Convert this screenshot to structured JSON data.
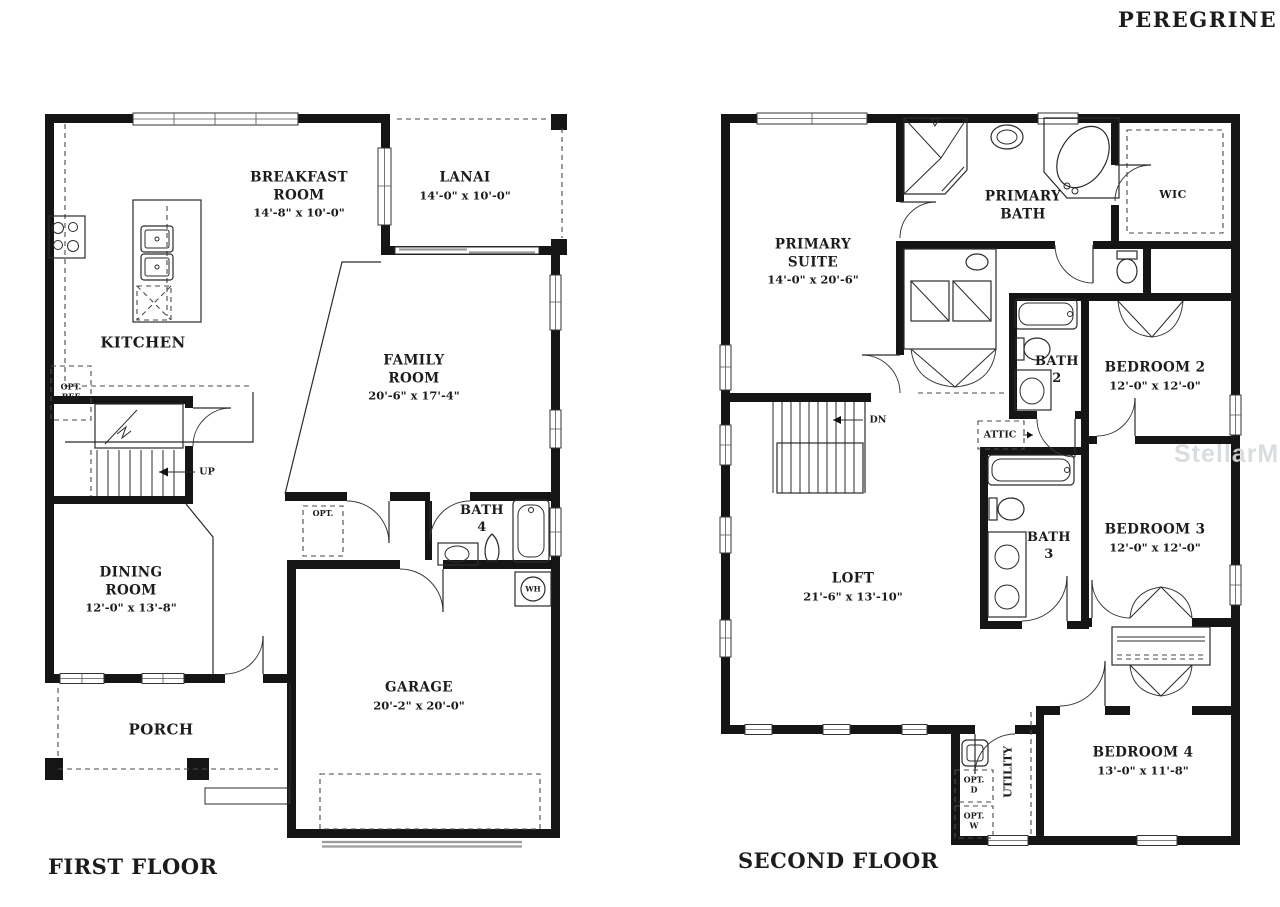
{
  "plan_title": "PEREGRINE",
  "watermark": "StellarMLS",
  "first_floor": {
    "label": "FIRST FLOOR",
    "rooms": {
      "breakfast": {
        "line1": "BREAKFAST",
        "line2": "ROOM",
        "dims": "14'-8\" x 10'-0\""
      },
      "lanai": {
        "line1": "LANAI",
        "dims": "14'-0\" x 10'-0\""
      },
      "kitchen": {
        "line1": "KITCHEN"
      },
      "family": {
        "line1": "FAMILY",
        "line2": "ROOM",
        "dims": "20'-6\" x 17'-4\""
      },
      "dining": {
        "line1": "DINING",
        "line2": "ROOM",
        "dims": "12'-0\" x 13'-8\""
      },
      "bath4": {
        "line1": "BATH",
        "line2": "4"
      },
      "garage": {
        "line1": "GARAGE",
        "dims": "20'-2\" x 20'-0\""
      },
      "porch": {
        "line1": "PORCH"
      }
    },
    "annotations": {
      "up": "UP",
      "opt": "OPT.",
      "opt_ref_1": "OPT.",
      "opt_ref_2": "REF",
      "wh": "WH"
    }
  },
  "second_floor": {
    "label": "SECOND FLOOR",
    "rooms": {
      "primary_suite": {
        "line1": "PRIMARY",
        "line2": "SUITE",
        "dims": "14'-0\" x 20'-6\""
      },
      "primary_bath": {
        "line1": "PRIMARY",
        "line2": "BATH"
      },
      "wic": {
        "line1": "WIC"
      },
      "bedroom2": {
        "line1": "BEDROOM 2",
        "dims": "12'-0\" x 12'-0\""
      },
      "bath2": {
        "line1": "BATH",
        "line2": "2"
      },
      "bedroom3": {
        "line1": "BEDROOM 3",
        "dims": "12'-0\" x 12'-0\""
      },
      "bath3": {
        "line1": "BATH",
        "line2": "3"
      },
      "loft": {
        "line1": "LOFT",
        "dims": "21'-6\" x 13'-10\""
      },
      "bedroom4": {
        "line1": "BEDROOM 4",
        "dims": "13'-0\" x 11'-8\""
      },
      "utility": {
        "line1": "UTILITY"
      }
    },
    "annotations": {
      "dn": "DN",
      "attic": "ATTIC",
      "opt_d_1": "OPT.",
      "opt_d_2": "D",
      "opt_w_1": "OPT.",
      "opt_w_2": "W"
    }
  }
}
